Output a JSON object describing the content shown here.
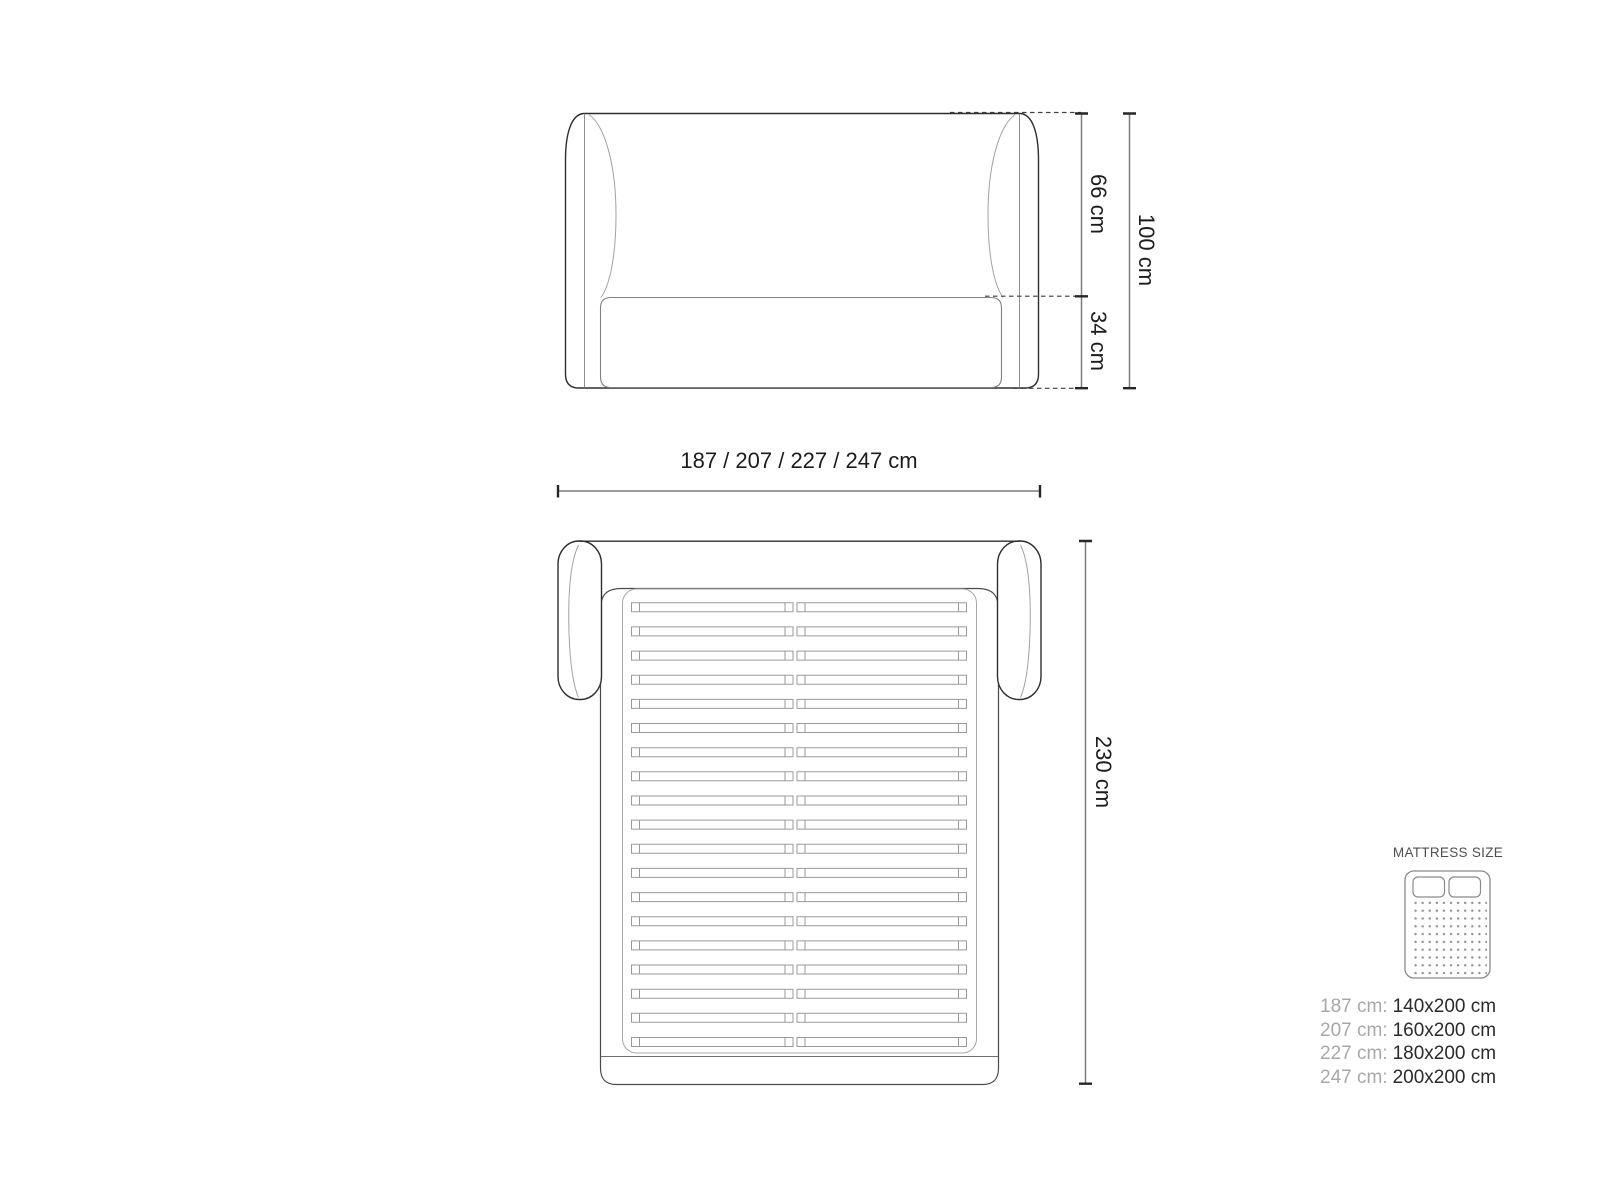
{
  "front_view": {
    "dim_upper_label": "66 cm",
    "dim_lower_label": "34 cm",
    "dim_total_label": "100 cm"
  },
  "width_dimension_label": "187 / 207 / 227 / 247 cm",
  "top_view": {
    "dim_length_label": "230 cm",
    "slat_rows": 19
  },
  "legend": {
    "title": "MATTRESS SIZE",
    "icon": "mattress-icon",
    "rows": [
      {
        "label": "187 cm:",
        "value": "140x200 cm"
      },
      {
        "label": "207 cm:",
        "value": "160x200 cm"
      },
      {
        "label": "227 cm:",
        "value": "180x200 cm"
      },
      {
        "label": "247 cm:",
        "value": "200x200 cm"
      }
    ]
  },
  "colors": {
    "outline": "#2e2e2e",
    "line_light": "#a2a2a2",
    "line_medium": "#7c7c7c",
    "tick": "#262626",
    "text": "#1c1c1c",
    "legend_label": "#a8a8a8",
    "legend_value": "#2b2b2b",
    "legend_title": "#4f4f4f"
  }
}
